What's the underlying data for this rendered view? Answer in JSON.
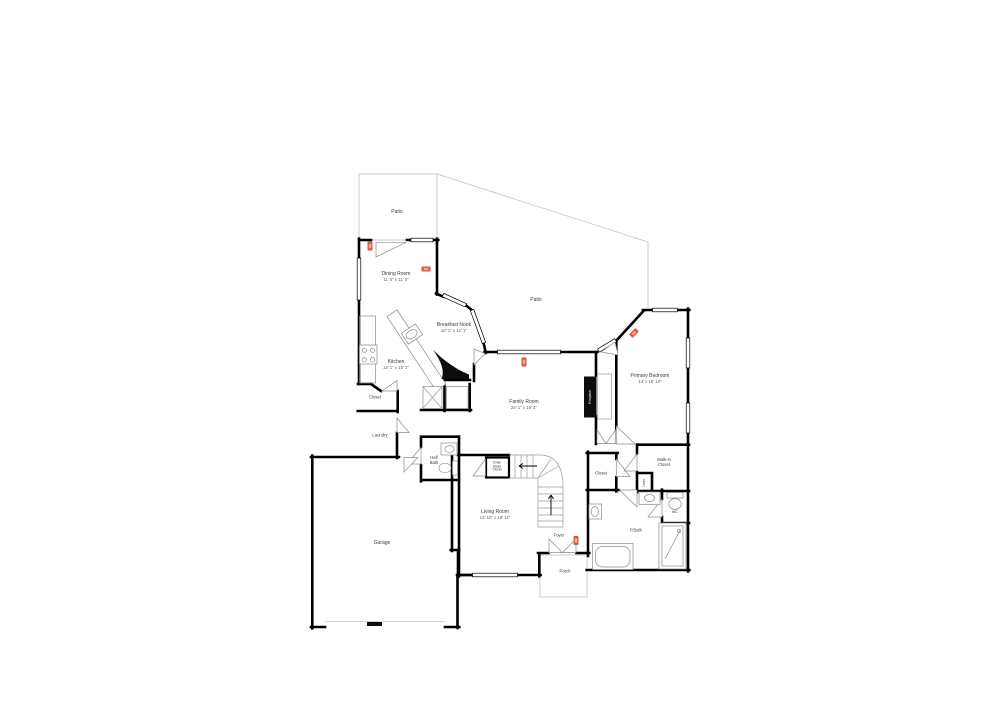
{
  "colors": {
    "wall": "#000000",
    "thin_line": "#c2c2c2",
    "label": "#3b3b3b",
    "dims": "#5d5d5d",
    "marker": "#d8593a",
    "marker_light": "#f3ab8e"
  },
  "rooms": {
    "patio_upper": {
      "name": "Patio"
    },
    "patio_main": {
      "name": "Patio"
    },
    "dining_room": {
      "name": "Dining Room",
      "dims": "11' 0\" x 11' 4\""
    },
    "breakfast_nook": {
      "name": "Breakfast Nook",
      "dims": "10' 1\" x 12' 1\""
    },
    "kitchen": {
      "name": "Kitchen",
      "dims": "13' 1\" x 15' 2\""
    },
    "kitchen_closet": {
      "name": "Closet"
    },
    "laundry": {
      "name": "Laundry"
    },
    "half_bath": {
      "name": "Half Bath"
    },
    "garage": {
      "name": "Garage"
    },
    "living_room": {
      "name": "Living Room",
      "dims": "13' 10\" x 18' 11\""
    },
    "under_stairs_closet": {
      "name": "Under Stairs Closet"
    },
    "foyer": {
      "name": "Foyer"
    },
    "porch": {
      "name": "Porch"
    },
    "family_room": {
      "name": "Family Room",
      "dims": "24' 1\" x 16' 2\""
    },
    "fireplace": {
      "name": "Fireplace"
    },
    "primary_bedroom": {
      "name": "Primary Bedroom",
      "dims": "14' x 19' 10\""
    },
    "hall_closet": {
      "name": "Closet"
    },
    "walk_in_closet": {
      "name": "Walk-In Closet"
    },
    "linen": {
      "name": "Linen"
    },
    "wc": {
      "name": "WC"
    },
    "primary_bath": {
      "name": "P.Bath"
    }
  }
}
